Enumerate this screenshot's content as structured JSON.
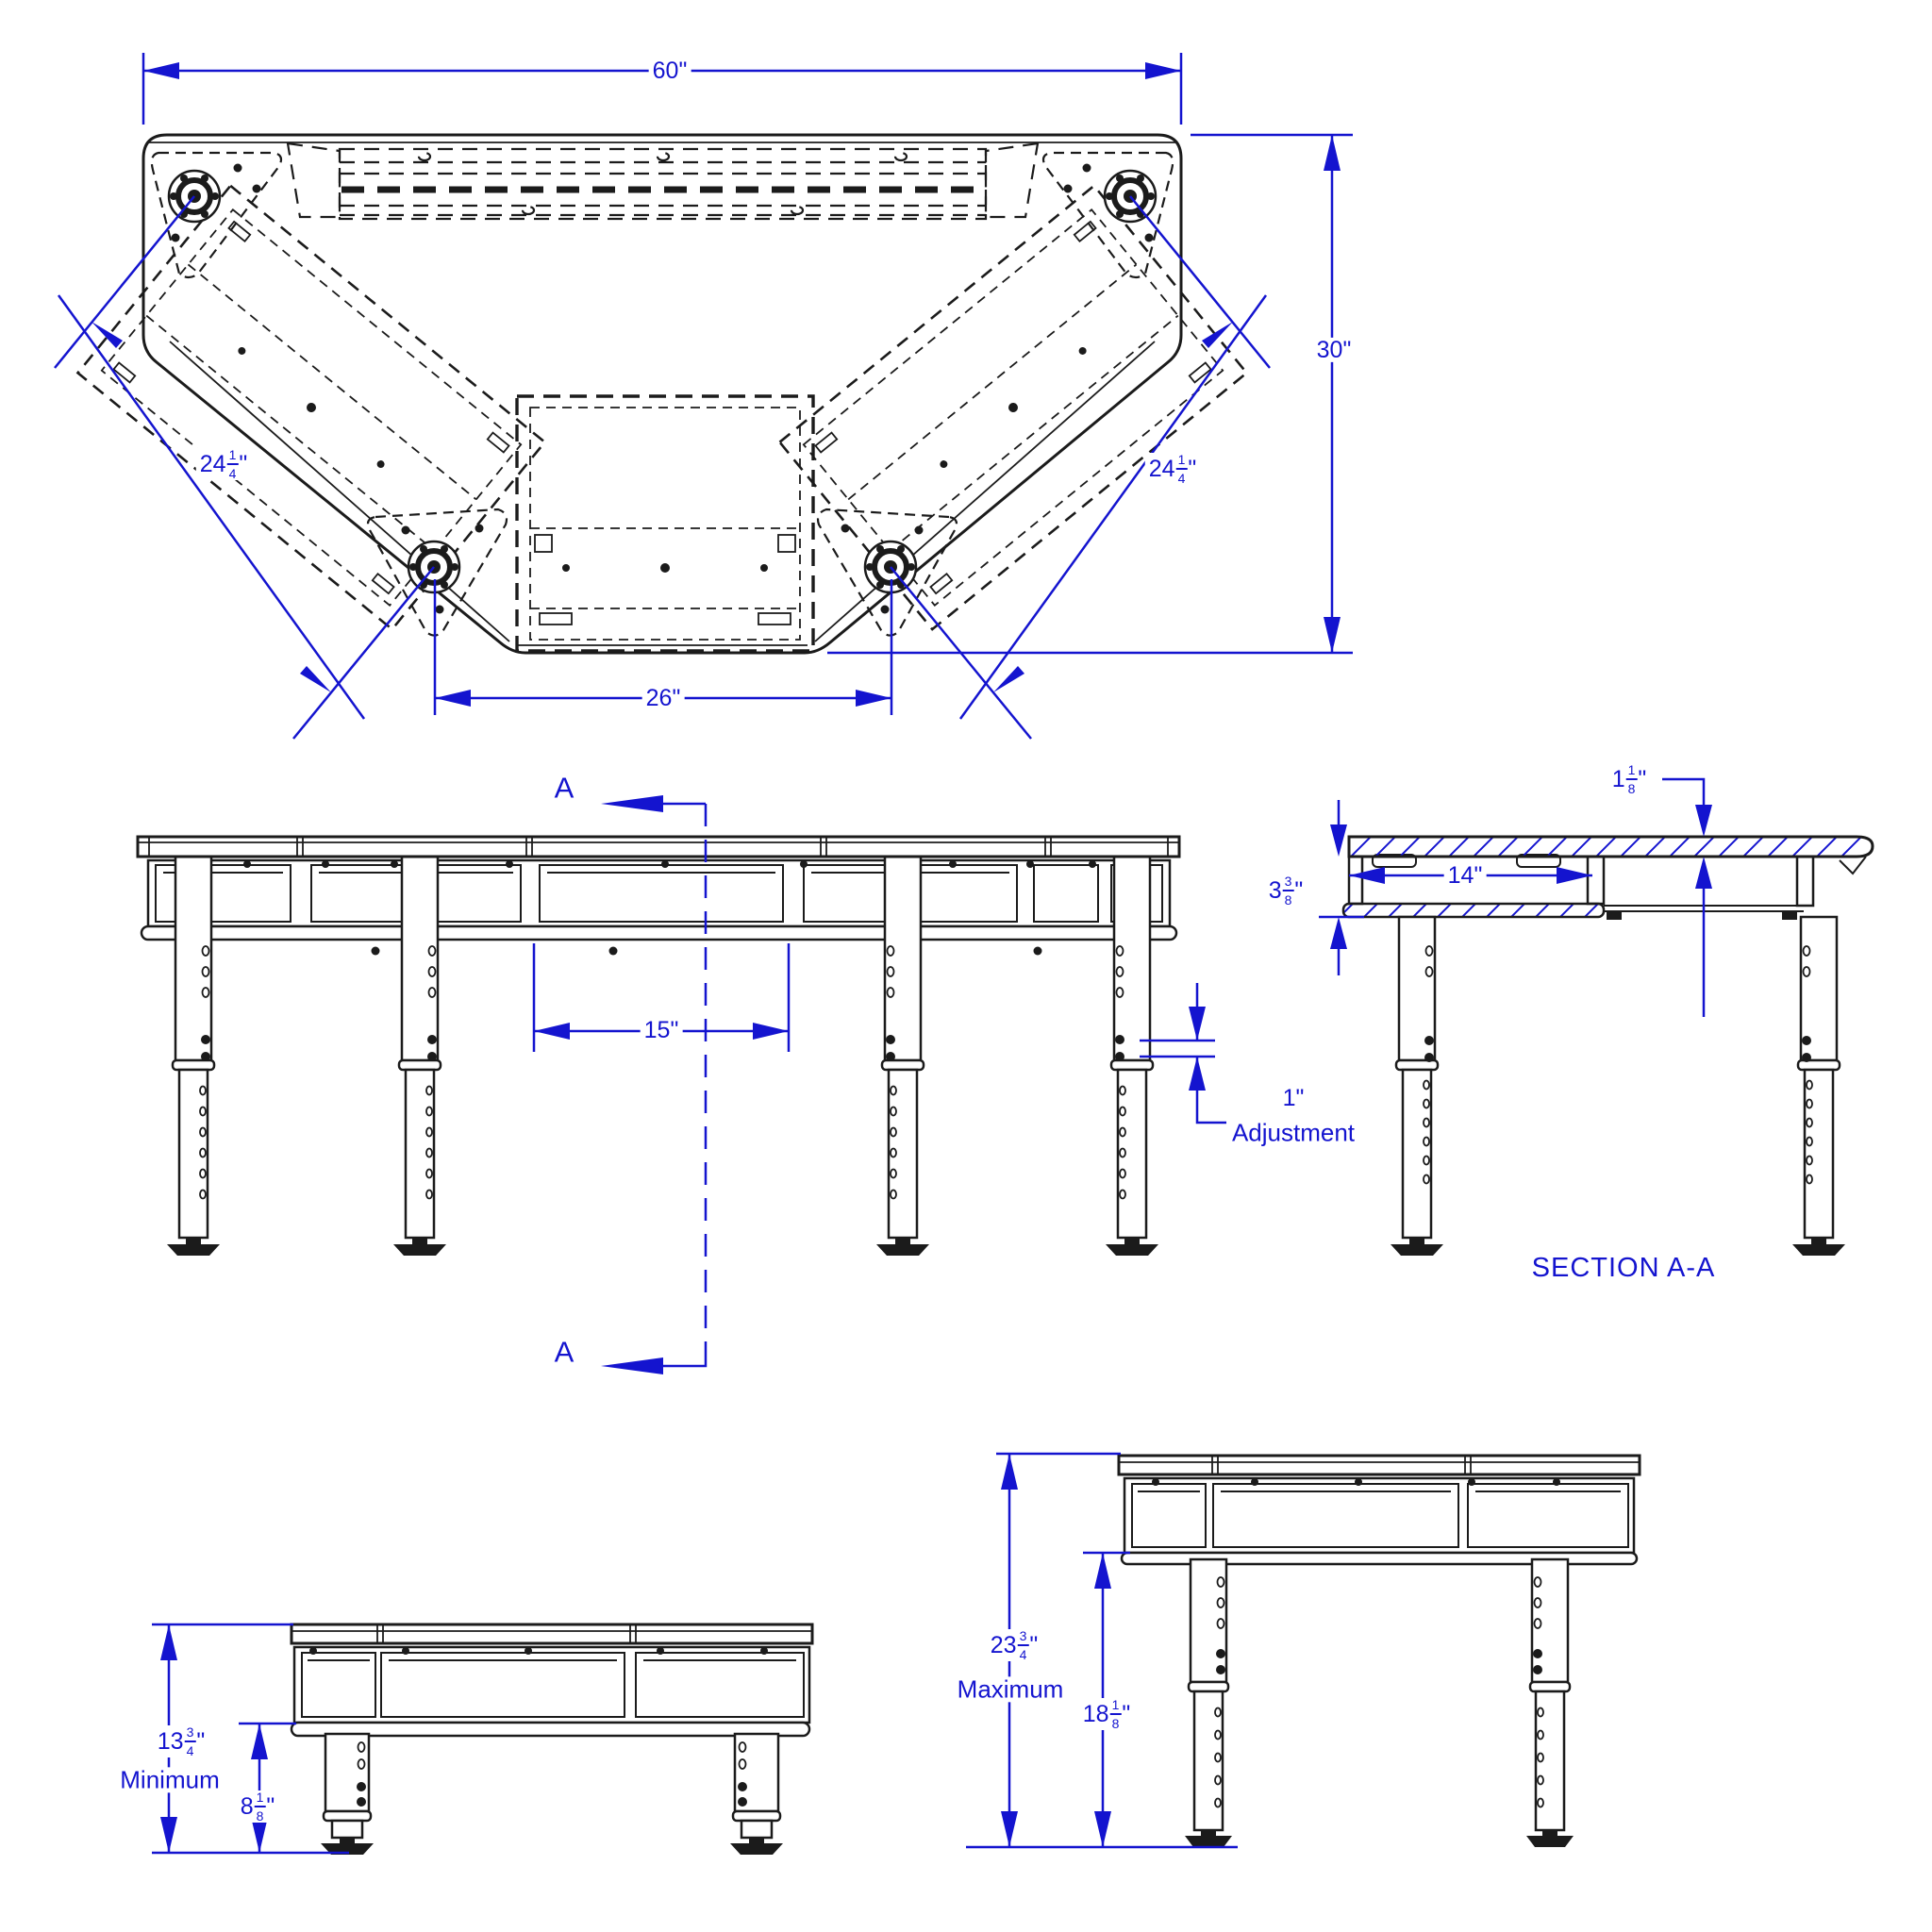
{
  "colors": {
    "dimension": "#1414cf",
    "line": "#1b1b1b",
    "background": "#ffffff"
  },
  "views": {
    "top_view": {
      "dim_width": "60\"",
      "dim_depth": "30\"",
      "dim_side_left": {
        "whole": "24",
        "num": "1",
        "den": "4",
        "unit": "\""
      },
      "dim_side_right": {
        "whole": "24",
        "num": "1",
        "den": "4",
        "unit": "\""
      },
      "dim_bottom": "26\""
    },
    "front_view": {
      "section_marker_top": "A",
      "section_marker_bottom": "A",
      "dim_center_opening": "15\"",
      "adjustment": {
        "value": "1\"",
        "label": "Adjustment"
      }
    },
    "section_view": {
      "title": "SECTION A-A",
      "dim_top_thickness": {
        "whole": "1",
        "num": "1",
        "den": "8",
        "unit": "\""
      },
      "dim_apron_depth": {
        "whole": "3",
        "num": "3",
        "den": "8",
        "unit": "\""
      },
      "dim_opening": "14\""
    },
    "minimum_view": {
      "dim_overall": {
        "whole": "13",
        "num": "3",
        "den": "4",
        "unit": "\""
      },
      "label": "Minimum",
      "dim_clearance": {
        "whole": "8",
        "num": "1",
        "den": "8",
        "unit": "\""
      }
    },
    "maximum_view": {
      "dim_overall": {
        "whole": "23",
        "num": "3",
        "den": "4",
        "unit": "\""
      },
      "label": "Maximum",
      "dim_clearance": {
        "whole": "18",
        "num": "1",
        "den": "8",
        "unit": "\""
      }
    }
  }
}
